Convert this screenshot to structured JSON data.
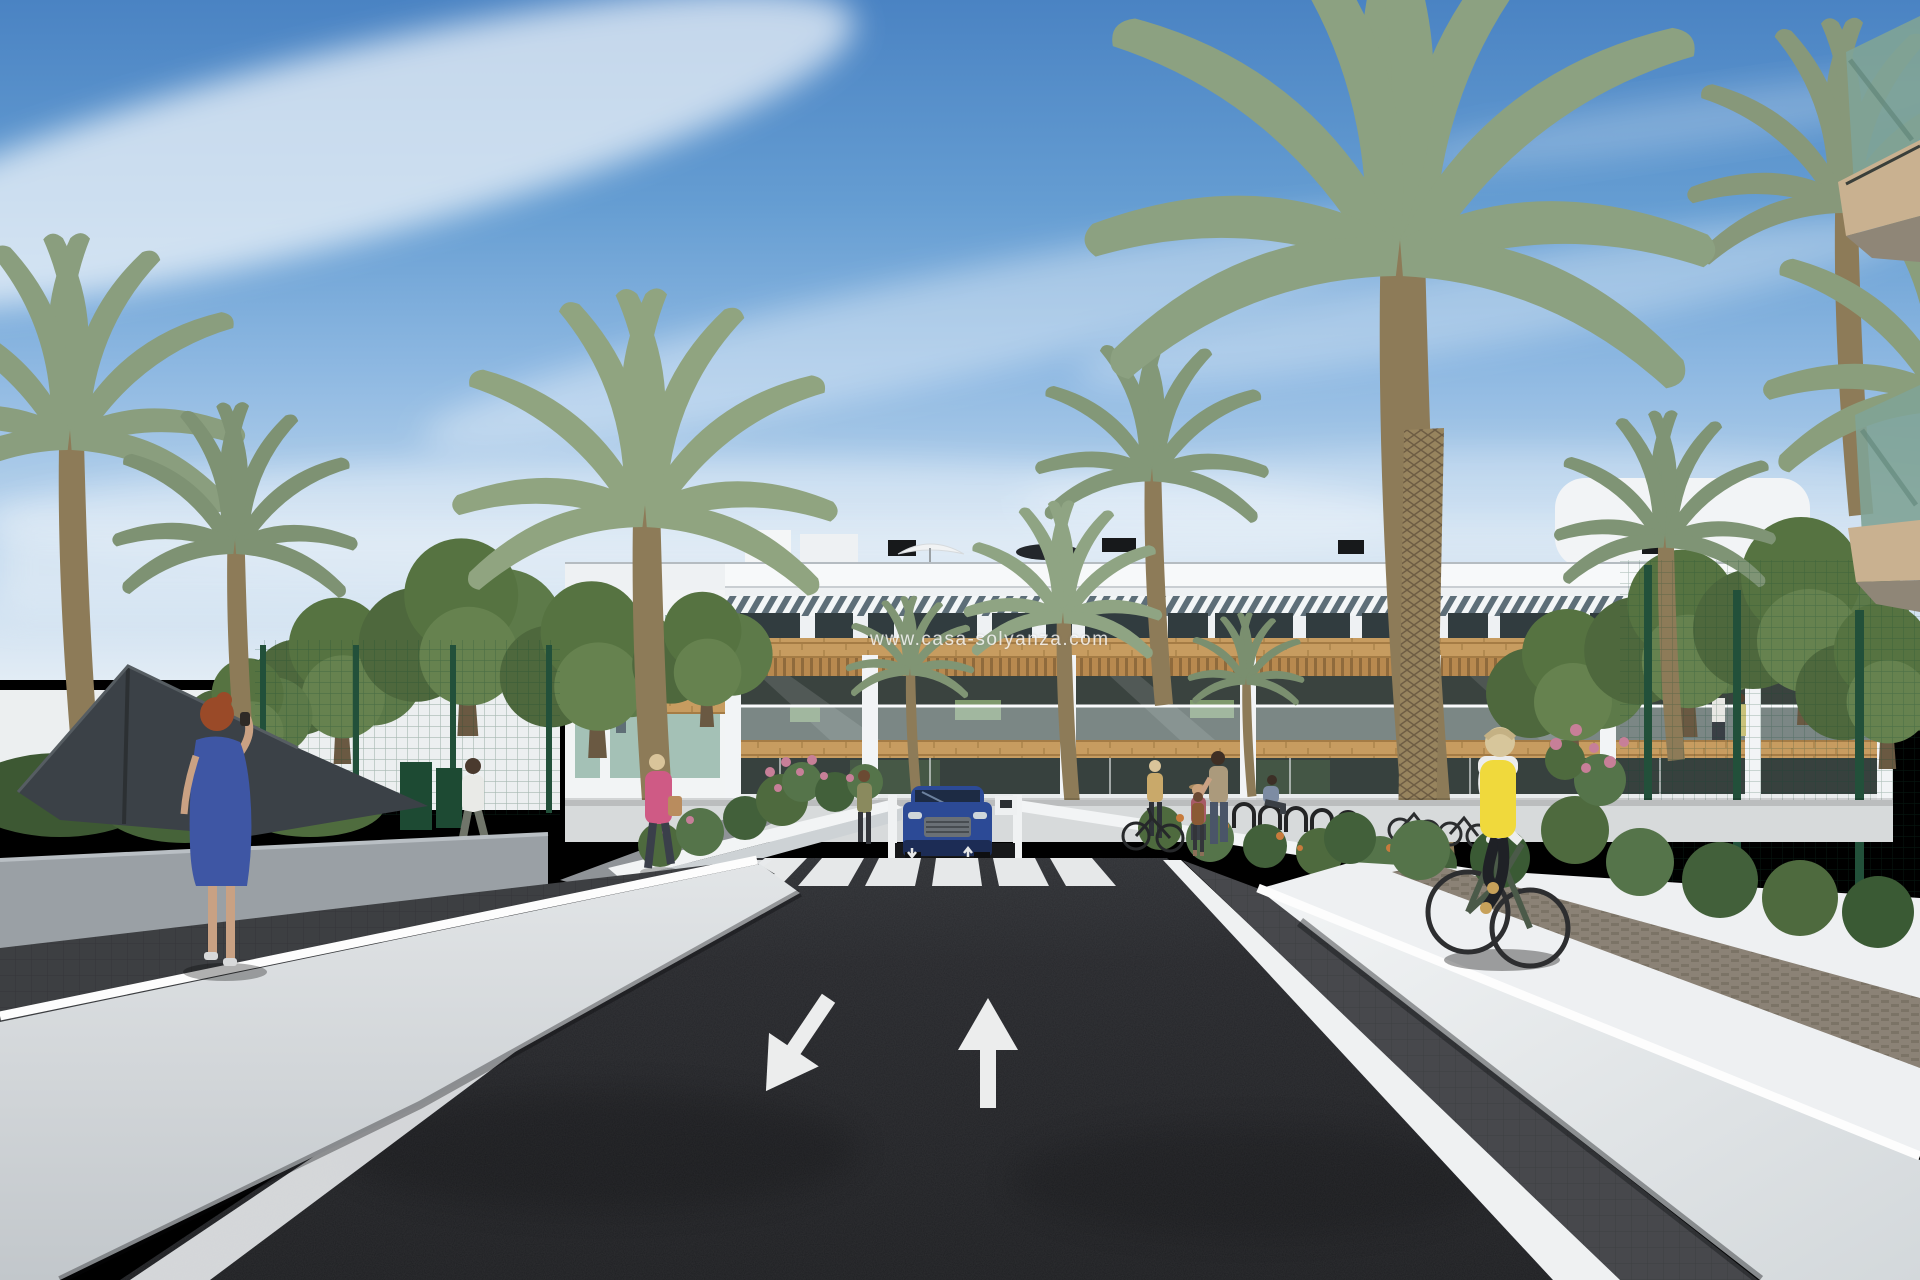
{
  "scene": {
    "type": "3d-architectural-render",
    "subject": "Modern white apartment complex street view with palm trees, pedestrians and a cyclist",
    "watermark": {
      "text": "www.casa-solyanza.com"
    },
    "road_markings": {
      "lane_arrow_left": "toward-viewer",
      "lane_arrow_right": "ahead",
      "crosswalk_stripes": 6,
      "ramp_arrows": [
        "down",
        "up"
      ]
    },
    "inventory": {
      "vehicles": [
        "blue SUV at underground garage ramp"
      ],
      "people": [
        "red-haired woman in blue dress taking photo",
        "man in white shirt",
        "woman in pink jacket with handbag",
        "woman in olive top",
        "woman with sun hat",
        "adult with child",
        "seated person",
        "woman standing with bicycle",
        "cyclist in yellow vest",
        "couple on balcony"
      ],
      "structures": [
        "three-story white apartment building with wood accents and pergolas",
        "rooftop terrace with parasols and vents",
        "green mesh fences",
        "white boundary walls and planters",
        "dark shade sail",
        "foreground corner balcony with green glass",
        "bicycle racks",
        "zebra crosswalk",
        "underground parking ramp"
      ],
      "vegetation": [
        "date palms",
        "round leafy trees",
        "pink flower bushes",
        "orange flower bushes",
        "grass"
      ]
    },
    "palette": {
      "sky_top": "#4a83c3",
      "sky_horizon": "#e2ecf5",
      "cloud": "#ffffff",
      "building_white": "#eef1f3",
      "wood_accent": "#c79c60",
      "window_glass": "#37413e",
      "balcony_glass": "#cddbdb",
      "palm_green": "#8a9e7e",
      "tree_green": "#5d7a49",
      "fence_green": "#22503a",
      "asphalt": "#232428",
      "marking_white": "#eceded",
      "wall_light": "#e8ebed",
      "wall_gray": "#9aa0a5",
      "paver_dark": "#3d3f42",
      "cobble_tan": "#8b8276",
      "car_blue": "#2c4a96",
      "vest_yellow": "#f0d93c",
      "dress_blue": "#3e56a4",
      "jacket_pink": "#cf5a85",
      "flower_pink": "#c77f98",
      "flower_orange": "#c87b3c"
    }
  }
}
